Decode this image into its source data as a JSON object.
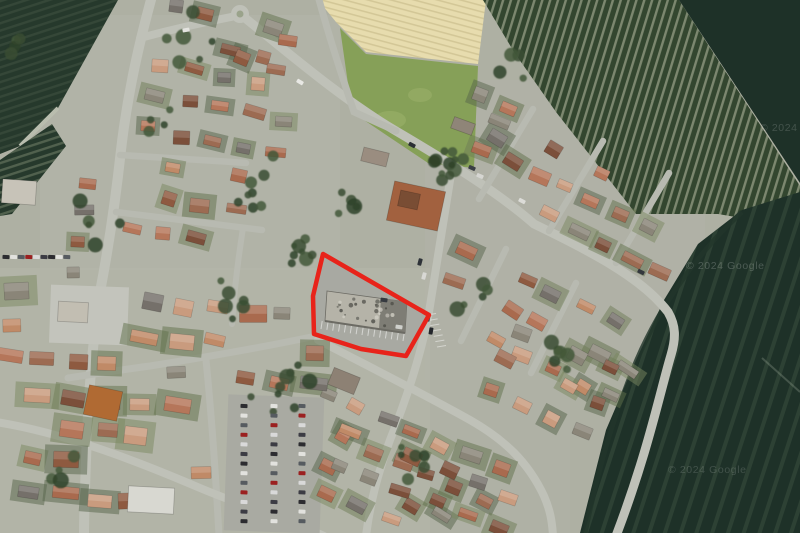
{
  "map": {
    "type": "satellite-imagery",
    "watermarks": [
      {
        "text": "© 2024 Google"
      },
      {
        "text": "© 2024"
      },
      {
        "text": "© 2024 Google"
      }
    ],
    "parcel": {
      "points": "323,254 429,315 406,356 361,349 314,334 313,296",
      "stroke": "#e8231a",
      "stroke_width": 4.5
    },
    "colors": {
      "urban_base": "#aeb0a3",
      "town_tint": "#b6b7ac",
      "field_dark": "#26392c",
      "field_dark2": "#1e3128",
      "vineyard_base": "#33462f",
      "vineyard_row": "#89937a",
      "field_beige": "#e7dcae",
      "grass": "#86a058",
      "grass_light": "#9db26b",
      "road": "#bfc1b8",
      "road_minor": "#b8bab1",
      "asphalt": "#a8a9a1",
      "building_roof": "#b5b3a8",
      "building_roof_dark": "#7e7d75",
      "tree": [
        "#3a4e33",
        "#2f4229",
        "#43573a"
      ],
      "roof_palette": [
        "#a96a4e",
        "#b5765a",
        "#8e5a40",
        "#c08a67",
        "#9c6b52",
        "#7b4f3a",
        "#c99b7e",
        "#8a8578",
        "#75706a"
      ],
      "garden_palette": [
        "#6d7b55",
        "#5f6f4a",
        "#7a8760",
        "#55644a"
      ],
      "car_palette": [
        "#2c2c30",
        "#e2e2de",
        "#565b60",
        "#9b2020",
        "#d9d9d9",
        "#3c3c44"
      ]
    }
  }
}
